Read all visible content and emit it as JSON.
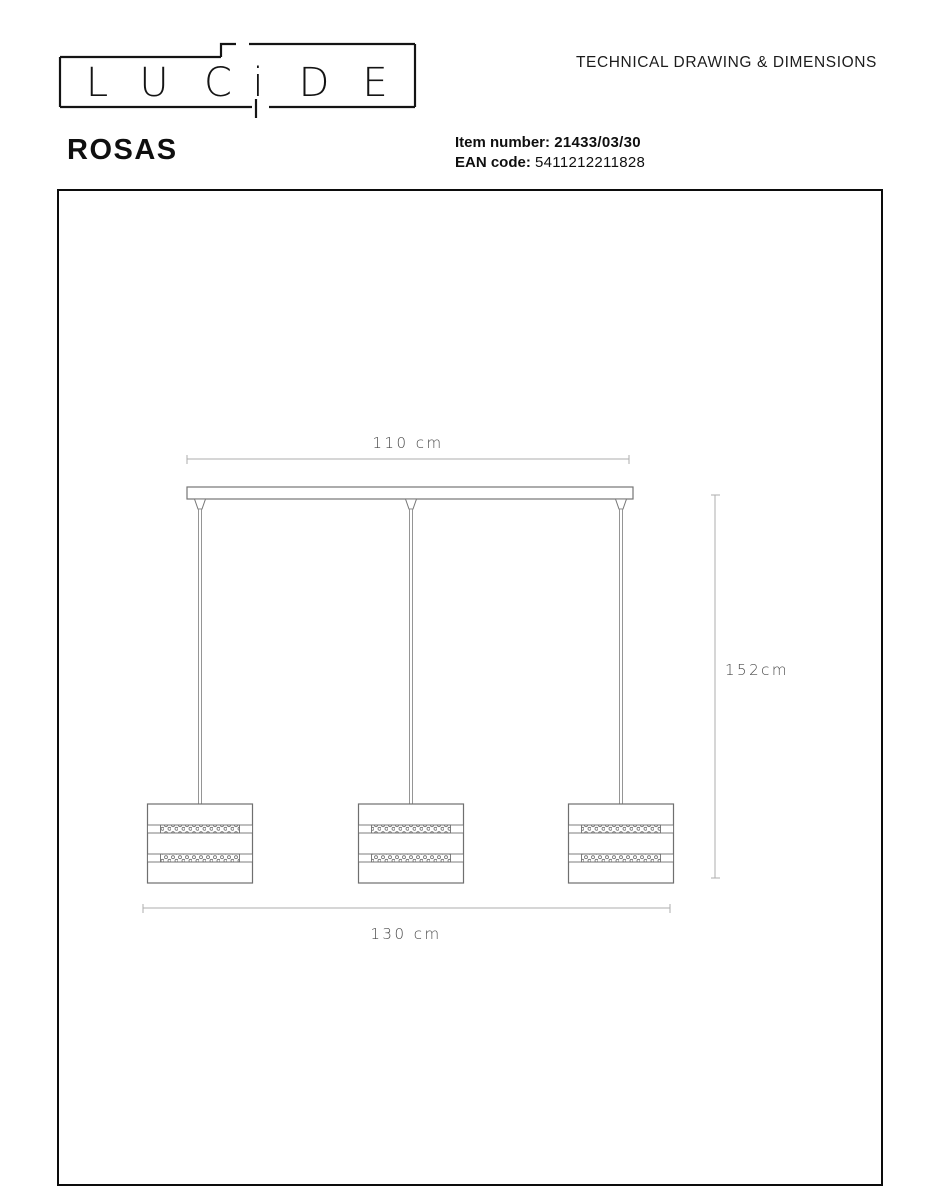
{
  "header": {
    "logo_letters": [
      "L",
      "U",
      "C",
      "i",
      "D",
      "E"
    ],
    "title": "TECHNICAL DRAWING & DIMENSIONS",
    "product_name": "ROSAS",
    "item_number_label": "Item number:",
    "item_number_value": "21433/03/30",
    "ean_label": "EAN code:",
    "ean_value": "5411212211828"
  },
  "drawing": {
    "canopy_width_label": "110 cm",
    "drop_height_label": "152cm",
    "total_width_label": "130 cm",
    "fixture_count": 3,
    "colors": {
      "outline": "#767676",
      "dimension_line": "#aeaeae",
      "dimension_text": "#4a4a4a",
      "header_text": "#0f0f0f"
    }
  }
}
